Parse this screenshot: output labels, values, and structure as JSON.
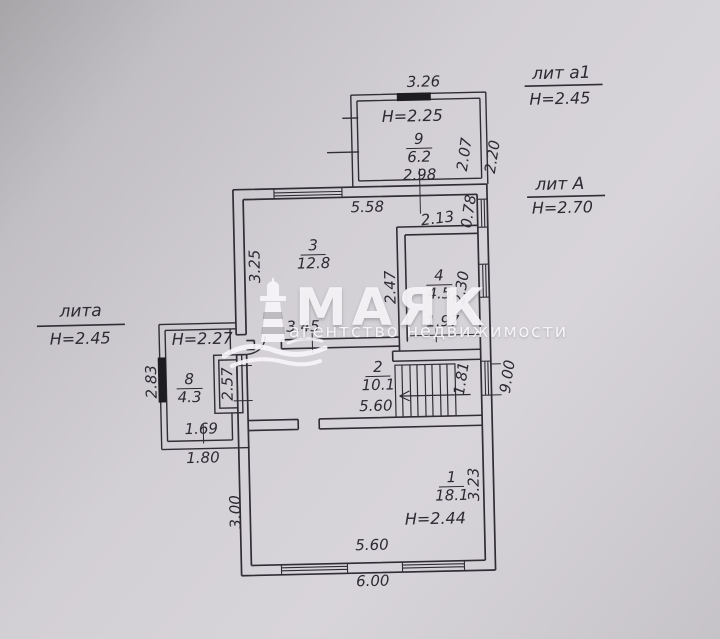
{
  "watermark": {
    "brand": "МАЯК",
    "tagline": "агентство недвижимости",
    "icon": "lighthouse-icon"
  },
  "captions": {
    "lit_a1": {
      "label": "лит а1",
      "height": "Н=2.45"
    },
    "lit_A": {
      "label": "лит А",
      "height": "Н=2.70"
    },
    "lit_a": {
      "label": "лита",
      "height": "Н=2.45"
    }
  },
  "rooms": {
    "r9": {
      "number": "9",
      "area": "6.2",
      "height": "Н=2.25"
    },
    "r3": {
      "number": "3",
      "area": "12.8"
    },
    "r4": {
      "number": "4",
      "area": "4.5"
    },
    "r8": {
      "number": "8",
      "area": "4.3",
      "height": "Н=2.27"
    },
    "r2": {
      "number": "2",
      "area": "10.1"
    },
    "r1": {
      "number": "1",
      "area": "18.1",
      "height": "Н=2.44"
    }
  },
  "dims": {
    "top_width_outer": "3.26",
    "r9_width_inner": "2.98",
    "r9_depth_inner": "2.07",
    "r9_depth_outer": "2.20",
    "r3_top": "5.58",
    "r3_top_right": "2.13",
    "win_078": "0.78",
    "r3_left": "3.25",
    "r3_right": "2.47",
    "r4_right": "2.30",
    "r4_width": "1.97",
    "r3_bottom": "3.45",
    "r8_left": "2.83",
    "r8_right": "2.57",
    "r8_bottom_inner": "1.69",
    "r8_bottom_outer": "1.80",
    "r2_width": "5.60",
    "win_181": "1.81",
    "right_total": "9.00",
    "r1_left": "3.00",
    "r1_right": "3.23",
    "r1_width": "5.60",
    "bottom_total": "6.00"
  },
  "colors": {
    "line": "#2f2e34",
    "paper": "#d5d2d7",
    "watermark": "#f6f4f8"
  }
}
